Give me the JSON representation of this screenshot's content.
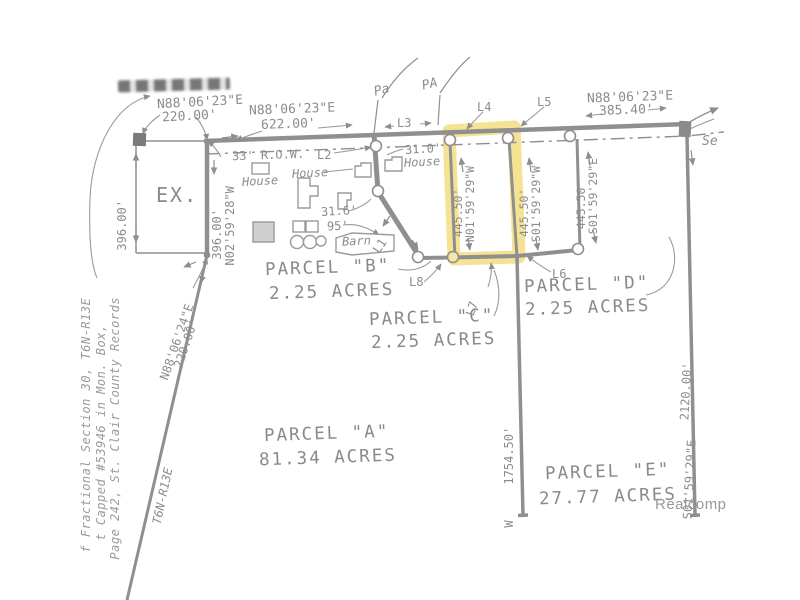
{
  "watermark": "Realcomp",
  "parcels": {
    "a": {
      "name": "PARCEL \"A\"",
      "area": "81.34 ACRES"
    },
    "b": {
      "name": "PARCEL \"B\"",
      "area": "2.25 ACRES"
    },
    "c": {
      "name": "PARCEL \"C\"",
      "area": "2.25 ACRES"
    },
    "d": {
      "name": "PARCEL \"D\"",
      "area": "2.25 ACRES"
    },
    "e": {
      "name": "PARCEL \"E\"",
      "area": "27.77 ACRES"
    }
  },
  "bearings": {
    "top_left": {
      "bearing": "N88'06'23\"E",
      "distance": "220.00'"
    },
    "top_center": {
      "bearing": "N88'06'23\"E",
      "distance": "622.00'"
    },
    "top_right": {
      "bearing": "N88'06'23\"E",
      "distance": "385.40'"
    },
    "ex_west": {
      "distance": "396.00'"
    },
    "ex_east": {
      "bearing": "N02'59'28\"W",
      "distance": "396.00'"
    },
    "ex_south": {
      "bearing": "N88'06'24\"E",
      "distance": "220.00'"
    },
    "parcel_c_west": {
      "bearing": "N01'59'29\"W",
      "distance": "445.50'"
    },
    "parcel_c_east": {
      "bearing": "S01'59'29\"W",
      "distance": "445.50'"
    },
    "parcel_d_east": {
      "bearing": "S01'59'29\"E",
      "distance": "445.50'"
    },
    "parcel_a_east": {
      "bearing": "W",
      "distance": "1754.50'"
    },
    "parcel_e_east": {
      "bearing": "S01'59'29\"E",
      "distance": "2120.00'"
    }
  },
  "line_labels": {
    "l1": "L1",
    "l2": "L2",
    "l3": "L3",
    "l4": "L4",
    "l5": "L5",
    "l6": "L6",
    "l7": "L7",
    "l8": "L8"
  },
  "features": {
    "ex": "EX.",
    "row": "33' R.O.W.",
    "house1": "House",
    "house2": "House",
    "house3": "House",
    "house3_width": "31.0'",
    "barn": "Barn",
    "dim_31_6": "31.6'",
    "dim_95": "95'",
    "partial_top_1": "Pa",
    "partial_top_2": "PA",
    "partial_right": "Se",
    "township": "T6N-R13E"
  },
  "survey_notes": [
    "f Fractional Section 30, T6N-R13E",
    "t Capped #53946 in Mon. Box,",
    "Page 242, St. Clair County Records"
  ]
}
